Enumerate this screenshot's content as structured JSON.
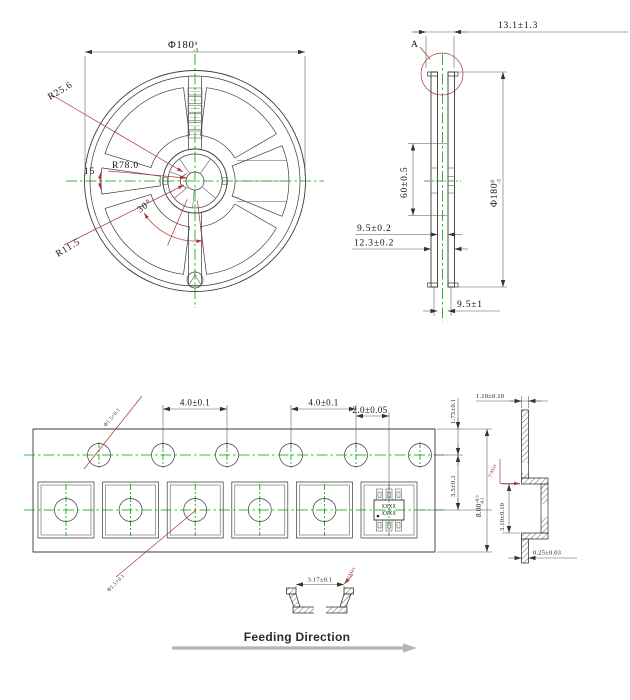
{
  "drawing": {
    "reel_front": {
      "diameter": {
        "main": "Φ180",
        "tol_up": "0",
        "tol_dn": "-3"
      },
      "r_hub": "R25.6",
      "r_flange": "R78.0",
      "r_center": "R11.5",
      "angle_left": "15",
      "angle_bottom": "30°"
    },
    "reel_side": {
      "overall_width": "13.1±1.3",
      "detail_label": "A",
      "hub_width": "60±0.5",
      "diameter": {
        "main": "Φ180",
        "tol_up": "0",
        "tol_dn": "-3"
      },
      "inner_gap": "9.5±0.2",
      "outer_width": "12.3±0.2",
      "bottom_gap": "9.5±1"
    },
    "tape_top": {
      "pocket_pitch_a": "4.0±0.1",
      "pocket_pitch_b": "4.0±0.1",
      "hole_to_pocket": "2.0±0.05",
      "edge_to_hole": "1.75±0.1",
      "hole_to_pocket_v": "3.5±0.1",
      "tape_width": {
        "main": "8.00",
        "tol_up": "+0.3",
        "tol_dn": "-0.1"
      },
      "sprocket_hole_dia": "Φ1.5+0.1",
      "pocket_hole_dia": "Φ1.5+0.1",
      "marking_line1": "XXXX",
      "marking_line2": "XXXX"
    },
    "tape_side": {
      "carrier_width": "1.10±0.10",
      "pocket_depth": "3.10±0.10",
      "tape_thickness": "0.25±0.03",
      "draft_angle": "3°Max"
    },
    "pocket_section": {
      "opening_width": "3.17±0.1",
      "draft_angle": "3°Max"
    },
    "footer": {
      "feeding_direction": "Feeding Direction"
    }
  },
  "colors": {
    "line": "#3a3a3a",
    "dim_text": "#111111",
    "red": "#aa3535",
    "green": "#00a000",
    "gray_arrow": "#b5b5b5"
  }
}
